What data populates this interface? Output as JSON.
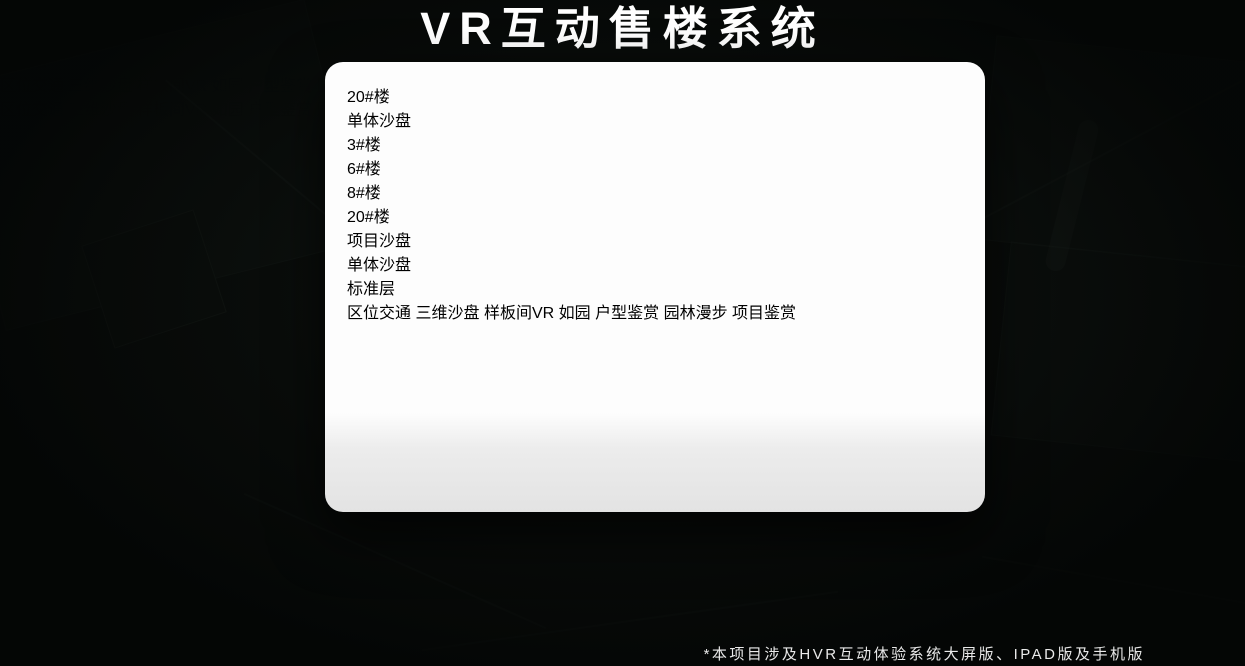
{
  "title": "VR互动售楼系统",
  "footnote": "*本项目涉及HVR互动体验系统大屏版、IPAD版及手机版",
  "brand": {
    "logo_text": "如园"
  },
  "colors": {
    "gold": "#c8a255",
    "gold_bright": "#e3b964",
    "tab_active_bg": "#dcb366",
    "screen_bg": "#0e0b07",
    "device_white": "#fdfdfd"
  },
  "monitor": {
    "heading": {
      "number": "20",
      "suffix": "#楼",
      "subtitle_vertical": "单体沙盘"
    },
    "floor_buttons": [
      {
        "label": "3#楼",
        "active": false
      },
      {
        "label": "6#楼",
        "active": false
      },
      {
        "label": "8#楼",
        "active": false
      },
      {
        "label": "20#楼",
        "active": true
      }
    ],
    "tabs": [
      {
        "label": "项目沙盘",
        "active": false
      },
      {
        "label": "单体沙盘",
        "active": true
      },
      {
        "label": "标准层",
        "active": false
      }
    ],
    "nav_items": [
      {
        "label": "区位交通",
        "active": false
      },
      {
        "label": "三维沙盘",
        "active": true
      },
      {
        "label": "样板间VR",
        "active": false
      },
      {
        "label": "户型鉴赏",
        "active": false
      },
      {
        "label": "园林漫步",
        "active": false
      },
      {
        "label": "项目鉴赏",
        "active": false
      }
    ]
  },
  "tablet": {
    "tabs": [
      {
        "label": "项目沙盘",
        "active": true
      },
      {
        "label": "单体沙盘",
        "active": false
      },
      {
        "label": "标准层",
        "active": false
      }
    ],
    "nav_items": [
      {
        "label": "区位交通",
        "active": false
      },
      {
        "label": "三维沙盘",
        "active": true
      },
      {
        "label": "样板间VR",
        "active": false
      },
      {
        "label": "户型鉴赏",
        "active": false
      },
      {
        "label": "园林漫步",
        "active": false
      },
      {
        "label": "项目鉴赏",
        "active": false
      }
    ]
  },
  "phone": {
    "nav_items": [
      {
        "label": "区位交通",
        "active": false
      },
      {
        "label": "三维沙盘",
        "active": false
      },
      {
        "label": "样板间VR",
        "active": false
      },
      {
        "label": "户型鉴赏",
        "active": false
      },
      {
        "label": "园林漫步",
        "active": true
      },
      {
        "label": "项目鉴赏",
        "active": false
      }
    ]
  }
}
